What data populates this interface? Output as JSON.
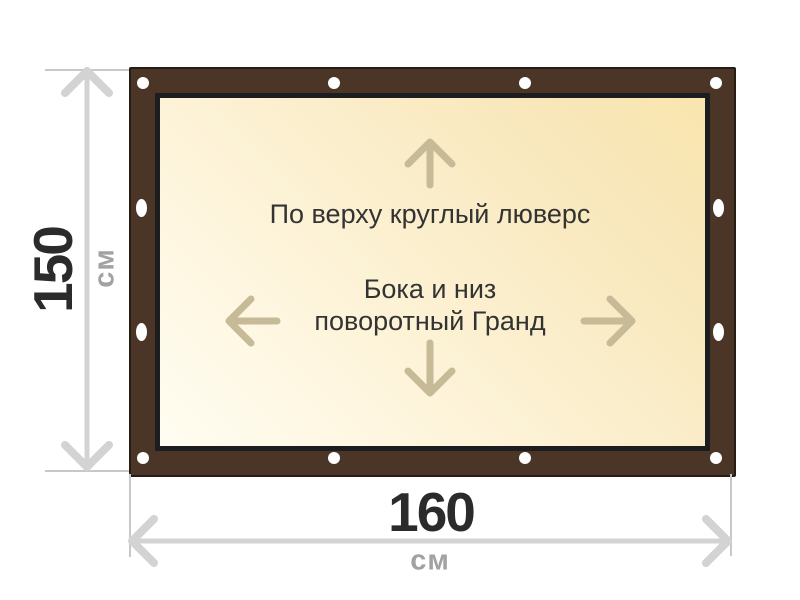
{
  "diagram": {
    "height": {
      "value": "150",
      "unit": "см"
    },
    "width": {
      "value": "160",
      "unit": "см"
    },
    "notes": {
      "top": "По верху круглый люверс",
      "sides_line1": "Бока и низ",
      "sides_line2": "поворотный Гранд"
    },
    "grommets": {
      "top": 4,
      "bottom": 4,
      "left": 2,
      "right": 2
    }
  },
  "colors": {
    "frame_brown": "#4a3527",
    "frame_outline": "#251c13",
    "inner_border": "#1d1d1f",
    "surface_light": "#fffdf2",
    "surface_mid": "#fdf3d8",
    "surface_warm": "#f8e7ba",
    "surface_deep": "#f9e5ae",
    "grommet_white": "#ffffff",
    "arrow_tan": "#c7ba97",
    "dimension_gray": "#d3d3d3",
    "tick_gray": "#c8c8c8",
    "dimension_text": "#2b2b2b",
    "unit_text": "#a2a2a2",
    "note_text": "#333333"
  }
}
